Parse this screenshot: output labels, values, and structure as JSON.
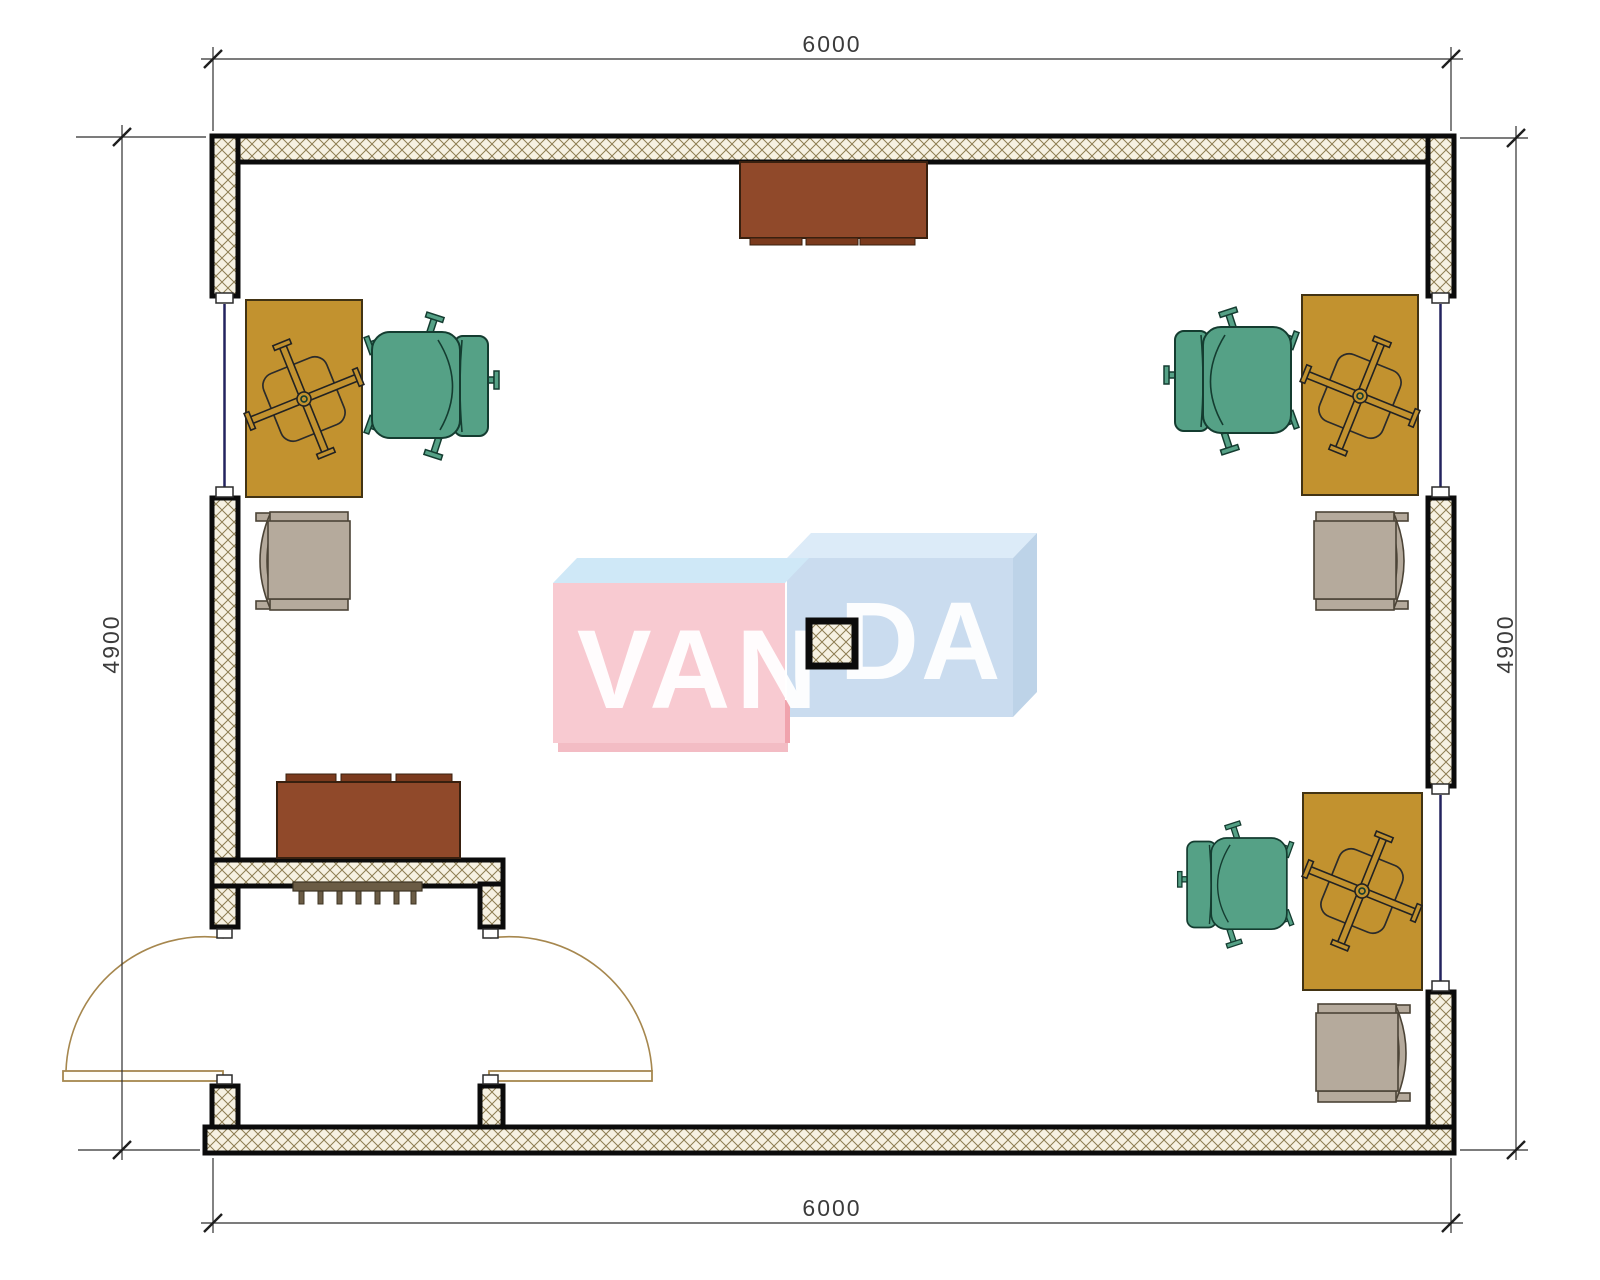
{
  "drawing_title": "office room floor plan",
  "dimensions": {
    "top": "6000",
    "bottom": "6000",
    "left": "4900",
    "right": "4900"
  },
  "watermark": {
    "text_left": "VAN",
    "text_right": "DA"
  },
  "palette": {
    "wall_bg": "#f6f1e2",
    "wall_hatch_line": "#8d7d52",
    "wall_edge": "#0b0b0b",
    "desk": "#c2922f",
    "chair_green": "#55a186",
    "chair_gray": "#b5aa9c",
    "cabinet": "#90492a",
    "radiator": "#6b5c45",
    "window": "#23235f",
    "door": "#a6874e",
    "dim": "#2f2f2f",
    "wm_pink": "#f8cad1",
    "wm_pink_top": "#cfe8f7",
    "wm_blue": "#cadcef",
    "wm_blue_top": "#dcebf8",
    "wm_blue_side": "#bdd3e8"
  }
}
